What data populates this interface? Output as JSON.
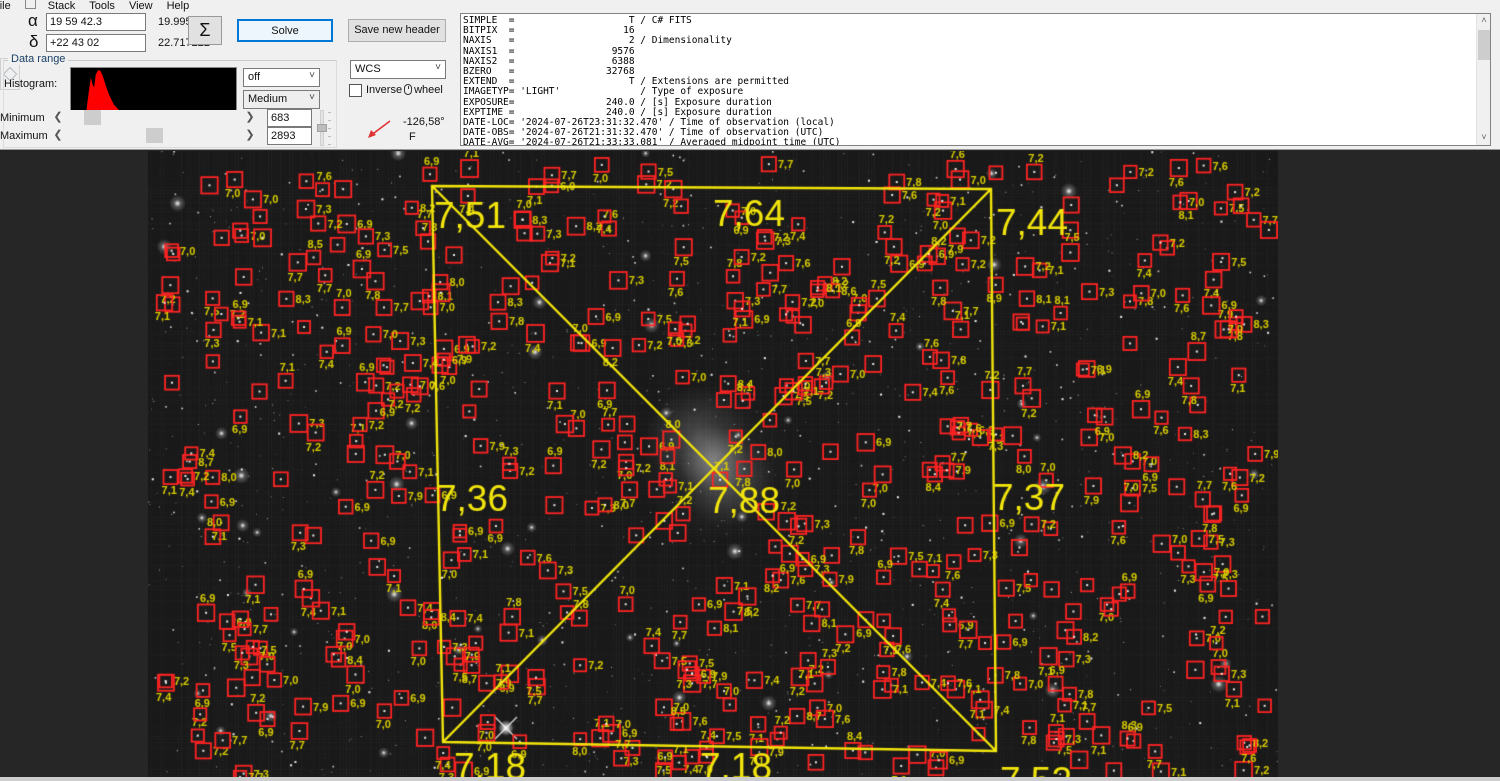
{
  "menu": {
    "items": [
      "File",
      "Stack",
      "Tools",
      "View",
      "Help"
    ]
  },
  "toolbar": {
    "alpha_label": "α",
    "alpha_value": "19 59 42.3",
    "alpha_degrees": "19.995083",
    "delta_label": "δ",
    "delta_value": "+22 43 02",
    "delta_degrees": "22.717222",
    "sigma_label": "Σ",
    "solve_label": "Solve",
    "save_header_label": "Save new header",
    "diamond_icon": "◇"
  },
  "data_range": {
    "group_label": "Data range",
    "histogram_label": "Histogram:",
    "stretch_dropdown": "off",
    "range_dropdown": "Medium",
    "minimum_label": "Minimum",
    "maximum_label": "Maximum",
    "minimum_value": "683",
    "maximum_value": "2893",
    "left_arrow": "❮",
    "right_arrow": "❯",
    "histogram_color": "#ff0000",
    "histogram_shape": [
      [
        0,
        100
      ],
      [
        9,
        100
      ],
      [
        10,
        72
      ],
      [
        11,
        45
      ],
      [
        12,
        20
      ],
      [
        13,
        34
      ],
      [
        14,
        42
      ],
      [
        15,
        14
      ],
      [
        16.5,
        4
      ],
      [
        18,
        7
      ],
      [
        19.5,
        20
      ],
      [
        21.5,
        42
      ],
      [
        23.5,
        60
      ],
      [
        26,
        78
      ],
      [
        29,
        89
      ],
      [
        33,
        96
      ],
      [
        38,
        99
      ],
      [
        44,
        100
      ],
      [
        100,
        100
      ]
    ]
  },
  "wcs_panel": {
    "wcs_dropdown": "WCS",
    "inverse_label_pre": "Inverse",
    "inverse_label_post": "wheel",
    "rotation_value": "-126,58°",
    "flip_indicator": "F",
    "arrow_color": "#e03434"
  },
  "fits_header": {
    "lines": [
      "SIMPLE  =                    T / C# FITS",
      "BITPIX  =                   16",
      "NAXIS   =                    2 / Dimensionality",
      "NAXIS1  =                 9576",
      "NAXIS2  =                 6388",
      "BZERO   =                32768",
      "EXTEND  =                    T / Extensions are permitted",
      "IMAGETYP= 'LIGHT'              / Type of exposure",
      "EXPOSURE=                240.0 / [s] Exposure duration",
      "EXPTIME =                240.0 / [s] Exposure duration",
      "DATE-LOC= '2024-07-26T23:31:32.470' / Time of observation (local)",
      "DATE-OBS= '2024-07-26T21:31:32.470' / Time of observation (UTC)",
      "DATE-AVG= '2024-07-26T21:33:33.081' / Averaged midpoint time (UTC)"
    ]
  },
  "viewer": {
    "outer_background": "#262626",
    "image_background": "#191919",
    "field_outline": {
      "color": "#f2e50c",
      "corners": [
        [
          284,
          35
        ],
        [
          843,
          38
        ],
        [
          848,
          600
        ],
        [
          295,
          591
        ]
      ],
      "diagonals": true
    },
    "hfd_grid_labels": [
      {
        "text": "7,51",
        "x": 286,
        "y": 77
      },
      {
        "text": "7,64",
        "x": 565,
        "y": 75
      },
      {
        "text": "7,44",
        "x": 848,
        "y": 84
      },
      {
        "text": "7,36",
        "x": 288,
        "y": 360
      },
      {
        "text": "7,88",
        "x": 560,
        "y": 362
      },
      {
        "text": "7,37",
        "x": 845,
        "y": 359
      },
      {
        "text": "7,18",
        "x": 306,
        "y": 628
      },
      {
        "text": "7,18",
        "x": 552,
        "y": 628
      },
      {
        "text": "7,52",
        "x": 852,
        "y": 642
      }
    ],
    "detections": {
      "count": 560,
      "box_color": "#ff2323",
      "label_color": "#d8cc00",
      "hfd_min": 6.9,
      "hfd_max": 8.9,
      "seed": 987654321
    },
    "nebula": {
      "x": 567,
      "y": 314,
      "radius": 80
    }
  }
}
